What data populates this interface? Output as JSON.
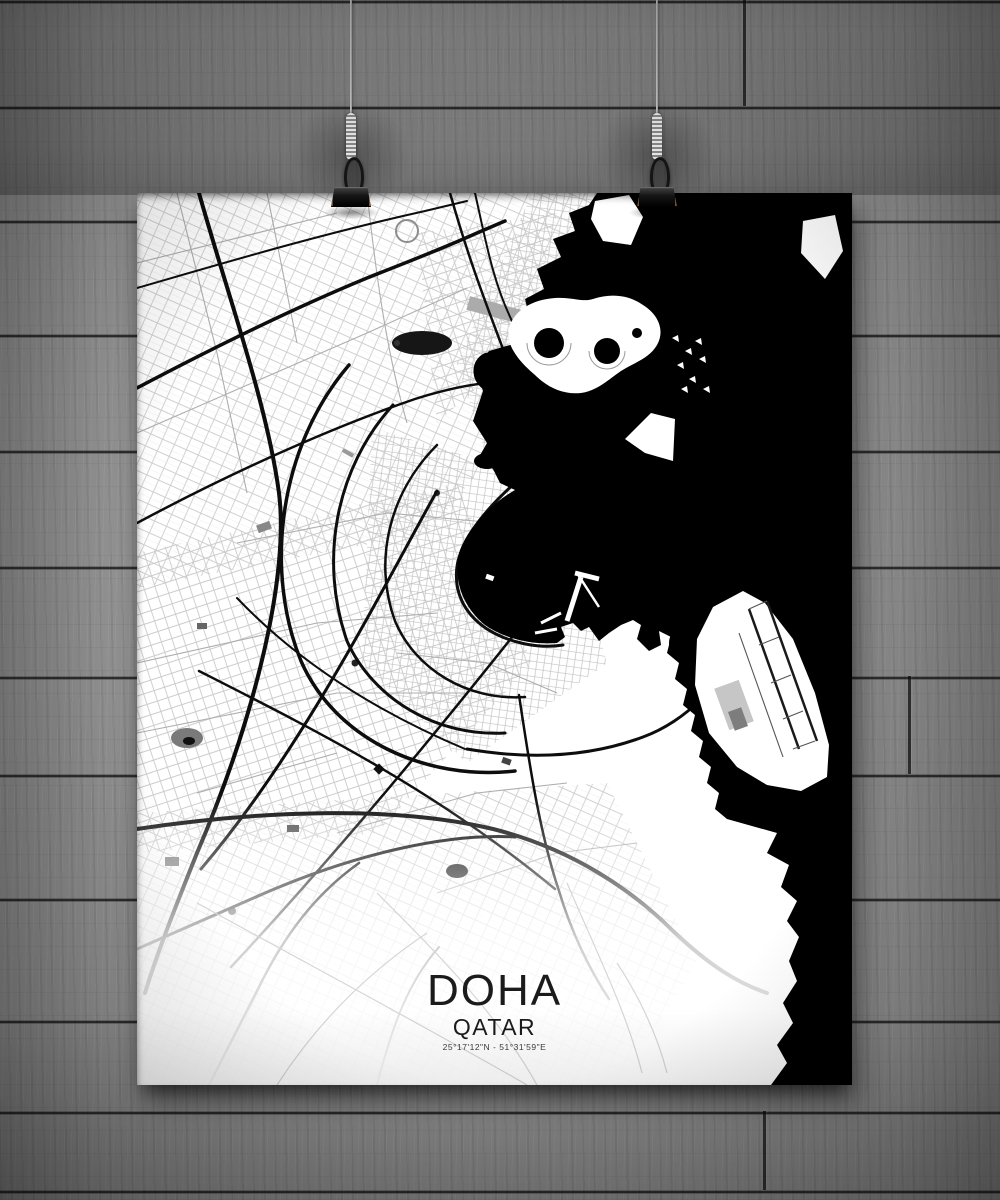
{
  "poster": {
    "title": "DOHA",
    "subtitle": "QATAR",
    "coordinates": "25°17'12\"N - 51°31'59\"E"
  },
  "scene": {
    "wall_color": "#8f8f8f",
    "wall_seam_color": "#1c1c1c",
    "poster_color": "#ffffff",
    "water_color": "#000000",
    "land_color": "#ffffff",
    "road_color": "#0d0d0d",
    "clip_color": "#141414",
    "string_color": "#d9d9d9",
    "text_color": "#1b1b1b"
  }
}
